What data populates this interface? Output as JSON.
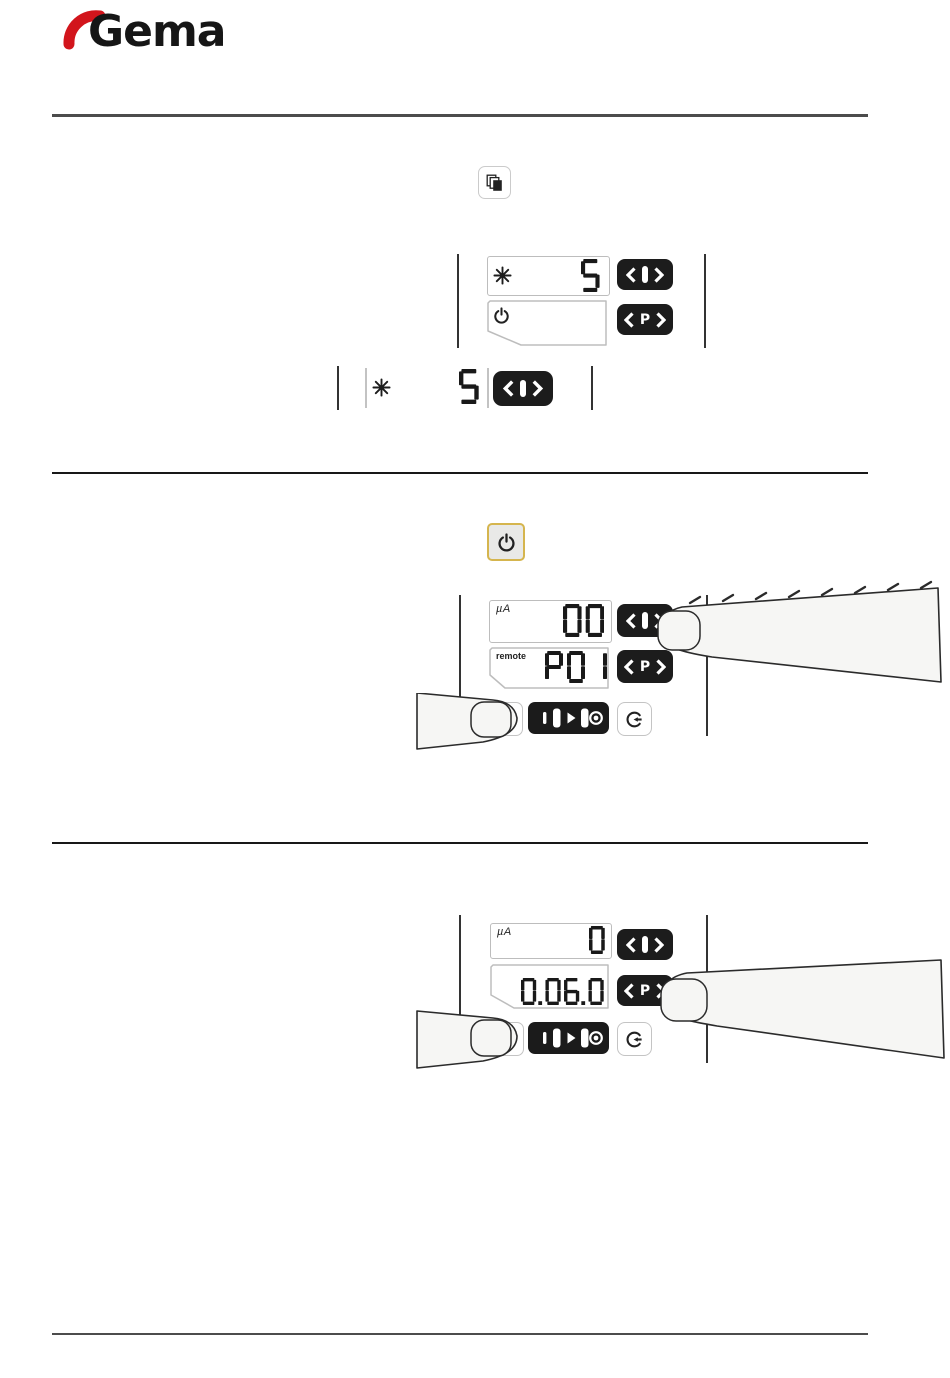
{
  "brand": {
    "name": "Gema",
    "red": "#d2151c",
    "black": "#161616"
  },
  "keys": {
    "chev_left": "<",
    "chev_right": ">",
    "program": "P"
  },
  "icons": {
    "copies_button": "stacked-pages",
    "star": "eight-spoke-asterisk",
    "power": "power-symbol",
    "mode_strip": [
      "short-bar",
      "tall-bar",
      "right-arrow",
      "tall-bar",
      "target-ring"
    ],
    "cycle": "arc-arrow"
  },
  "power_callout": {
    "highlight": "#d5b54e"
  },
  "figure1": {
    "row1": {
      "icon": "star",
      "value": "5"
    },
    "row2": {
      "icon": "power",
      "value": ""
    }
  },
  "figure1_zoom": {
    "row": {
      "icon": "star",
      "value": "5"
    }
  },
  "figure2": {
    "row1": {
      "unit": "µA",
      "value": "00"
    },
    "row2": {
      "label": "remote",
      "value": "P01"
    }
  },
  "figure3": {
    "row1": {
      "unit": "µA",
      "value": "0"
    },
    "row2": {
      "value": "0.06.0"
    }
  }
}
